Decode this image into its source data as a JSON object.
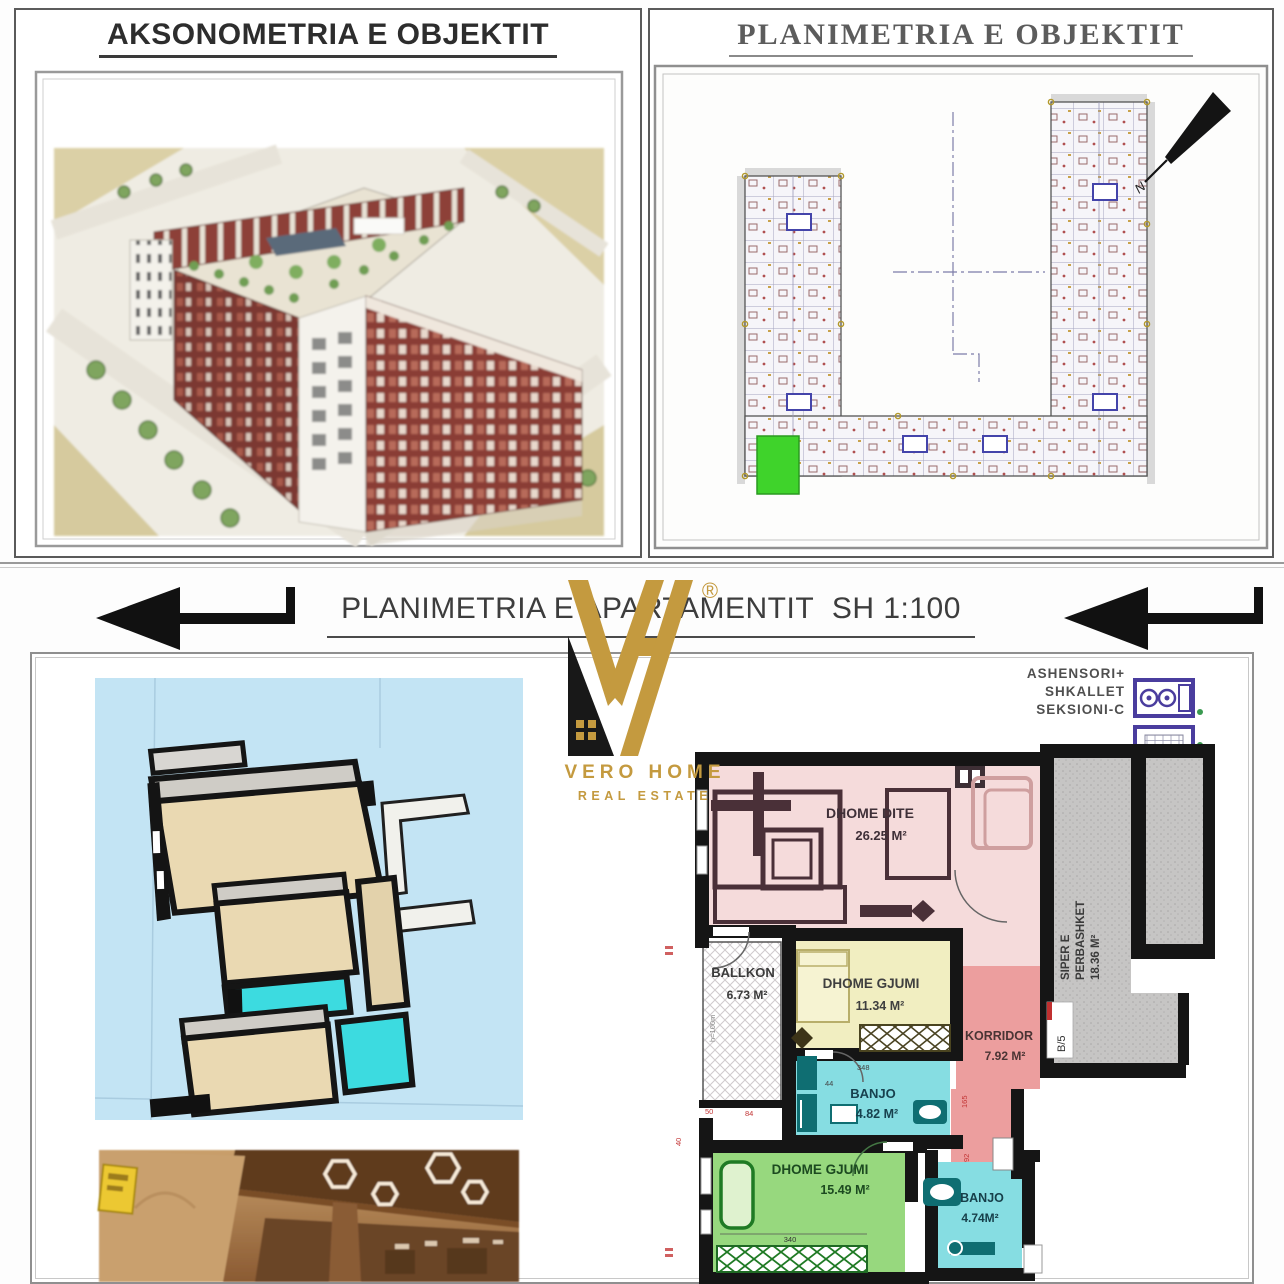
{
  "titles": {
    "axonometry": "AKSONOMETRIA E OBJEKTIT",
    "site_plan": "PLANIMETRIA E OBJEKTIT",
    "apartment_plan": "PLANIMETRIA E APARTAMENTIT  SH 1:100"
  },
  "logo": {
    "brand": "VERO HOME",
    "tagline": "REAL ESTATE",
    "registered": "®"
  },
  "site_plan": {
    "north": "N"
  },
  "apartment": {
    "note_line1": "ASHENSORI+",
    "note_line2": "SHKALLET",
    "note_line3": "SEKSIONI-C",
    "rooms": {
      "living_name": "DHOME DITE",
      "living_area": "26.25 M²",
      "balcony_name": "BALLKON",
      "balcony_area": "6.73 M²",
      "bedroom1_name": "DHOME GJUMI",
      "bedroom1_area": "11.34 M²",
      "corridor_name": "KORRIDOR",
      "corridor_area": "7.92 M²",
      "bath1_name": "BANJO",
      "bath1_area": "4.82 M²",
      "bedroom2_name": "DHOME GJUMI",
      "bedroom2_area": "15.49 M²",
      "bath2_name": "BANJO",
      "bath2_area": "4.74M²",
      "common_line1": "SIPER E",
      "common_line2": "PERBASHKET",
      "common_area": "18.36 M²"
    },
    "unit_label": "B/5",
    "balcony_note": "h=100m",
    "dims": {
      "d340": "340",
      "d348": "348",
      "d44": "44",
      "d165": "165",
      "d92": "92",
      "d50": "50",
      "d84": "84",
      "d40": "40"
    }
  },
  "colors": {
    "living": "#f5dbdb",
    "bedroom1": "#f1eec1",
    "bedroom2": "#97d87e",
    "bath": "#86dde2",
    "corridor": "#ec9e9e",
    "common_gray": "#c6c5c4",
    "highlight_unit": "#3fd32b",
    "logo_gold": "#c49a3f",
    "wall": "#151515"
  }
}
